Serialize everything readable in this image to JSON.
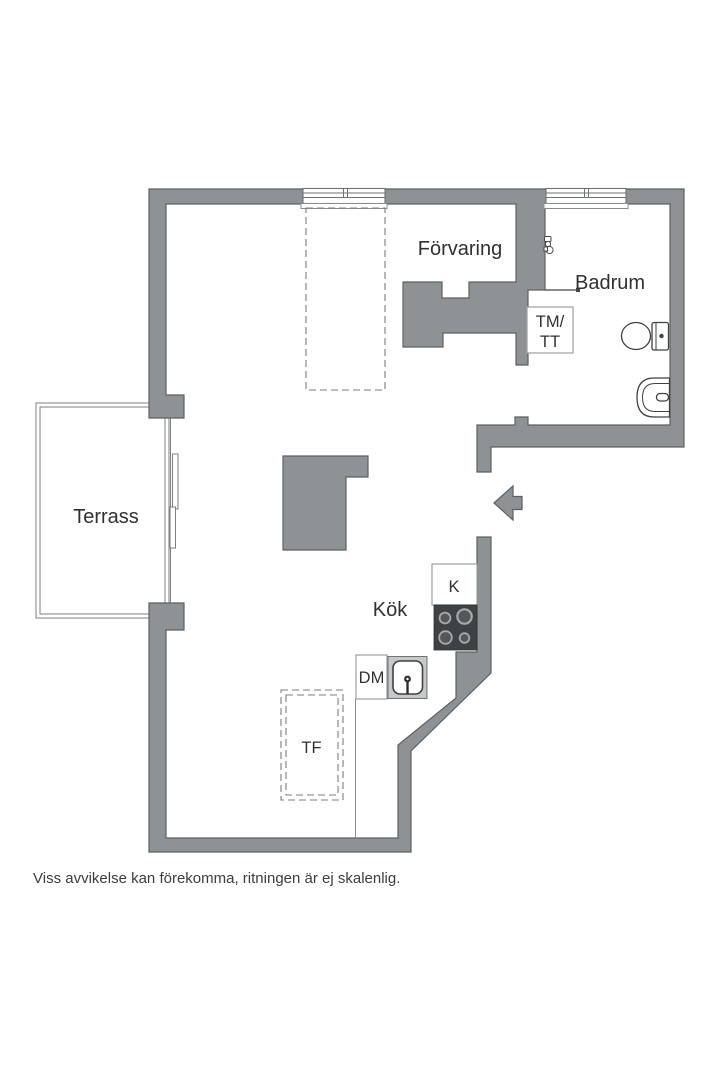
{
  "floor_plan": {
    "rooms": {
      "storage": "Förvaring",
      "bathroom": "Badrum",
      "terrace": "Terrass",
      "kitchen": "Kök"
    },
    "appliances": {
      "washer_dryer_top": "TM/",
      "washer_dryer_bottom": "TT",
      "fridge": "K",
      "dishwasher": "DM",
      "drying_cabinet": "TF"
    },
    "disclaimer": "Viss avvikelse kan förekomma, ritningen är ej skalenlig.",
    "colors": {
      "wall_fill": "#8f9294",
      "wall_outline": "#5d6062",
      "fixture_outline": "#3f4143",
      "stove_fill": "#3f4244",
      "text": "#2f3133"
    }
  }
}
